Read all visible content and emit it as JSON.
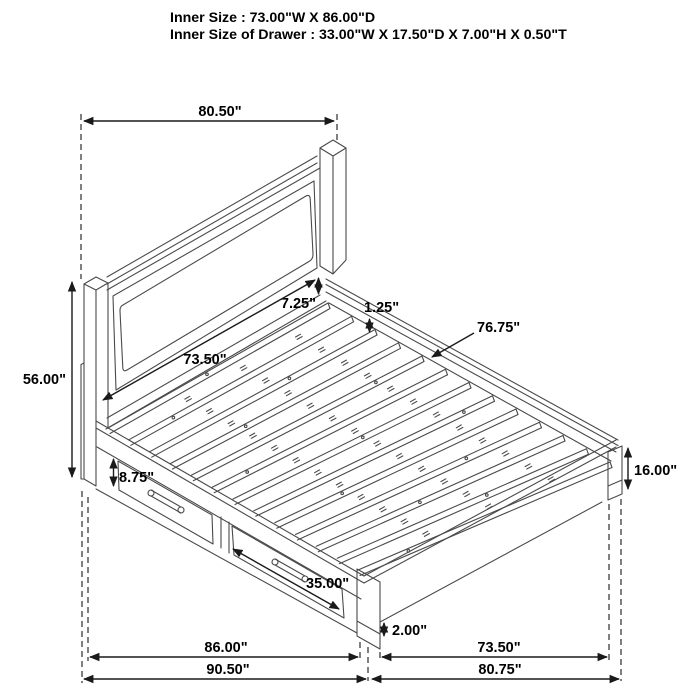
{
  "header": {
    "line1": "Inner Size : 73.00\"W X 86.00\"D",
    "line2": "Inner Size of Drawer : 33.00\"W X 17.50\"D X 7.00\"H X 0.50\"T"
  },
  "dims": {
    "headboard_width": "80.50\"",
    "headboard_height": "56.00\"",
    "panel_rail_gap": "7.25\"",
    "rail_cap_thickness": "1.25\"",
    "side_rail_length": "76.75\"",
    "headboard_inner_width": "73.50\"",
    "drawer_front_height": "8.75\"",
    "footboard_height": "16.00\"",
    "drawer_width": "35.00\"",
    "foot_leg_height": "2.00\"",
    "inner_length": "86.00\"",
    "overall_length": "90.50\"",
    "footboard_inner_width": "73.50\"",
    "footboard_outer_width": "80.75\""
  },
  "drawing": {
    "subject": "storage-bed-isometric-line-drawing",
    "slat_count": 13,
    "drawer_count": 2
  },
  "colors": {
    "line": "#4a4a4a",
    "dimension": "#1a1a1a",
    "text": "#000000",
    "background": "#ffffff"
  }
}
